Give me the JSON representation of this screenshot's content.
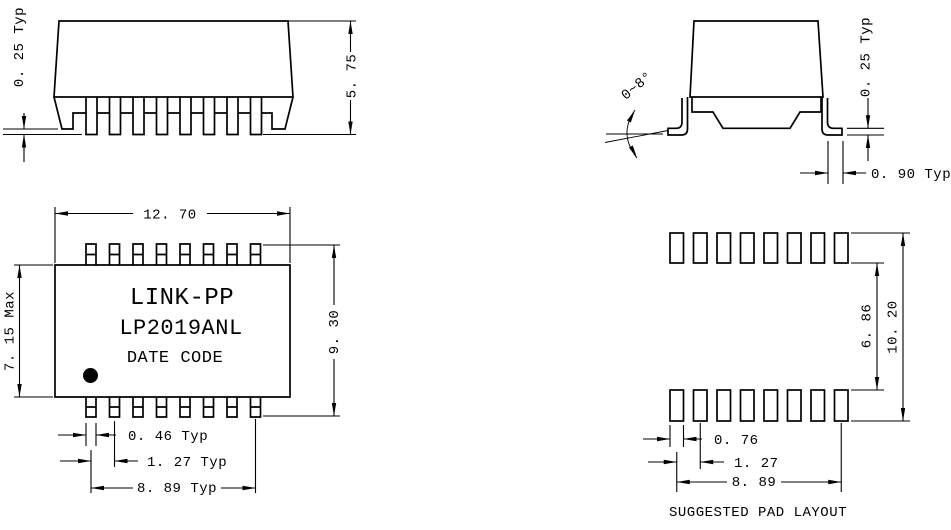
{
  "drawing": {
    "side_view": {
      "standoff_dim": "0. 25 Typ",
      "height_dim": "5. 75"
    },
    "end_view": {
      "lead_angle_dim": "0~8°",
      "lead_thickness_dim": "0. 25 Typ",
      "lead_foot_dim": "0. 90 Typ"
    },
    "top_view": {
      "width_dim": "12. 70",
      "depth_dim": "7. 15 Max",
      "span_dim": "9. 30",
      "brand": "LINK-PP",
      "part_number": "LP2019ANL",
      "date_code": "DATE CODE",
      "pin_width_dim": "0. 46 Typ",
      "pin_pitch_dim": "1. 27 Typ",
      "row_span_dim": "8. 89 Typ"
    },
    "pad_layout": {
      "inner_gap_dim": "6. 86",
      "outer_span_dim": "10. 20",
      "pad_width_dim": "0. 76",
      "pad_pitch_dim": "1. 27",
      "row_span_dim": "8. 89",
      "caption": "SUGGESTED PAD LAYOUT"
    }
  }
}
